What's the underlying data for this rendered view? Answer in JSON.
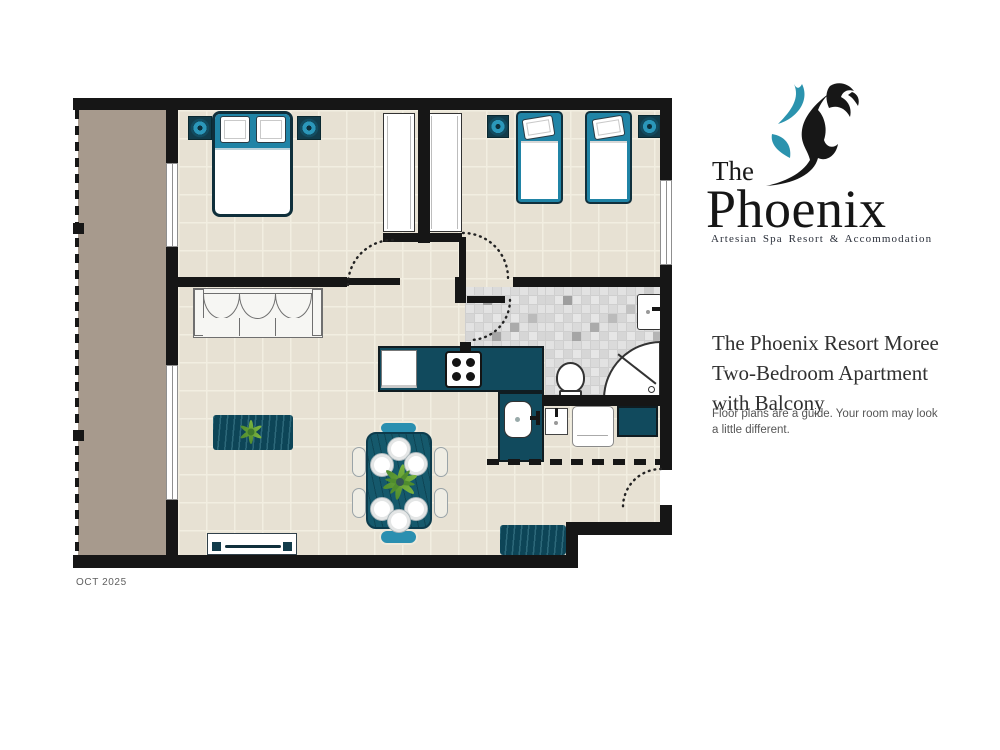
{
  "logo": {
    "prefix": "The",
    "name": "Phoenix",
    "tagline": "Artesian Spa Resort & Accommodation"
  },
  "details": {
    "title_lines": [
      "The Phoenix Resort Moree",
      "Two-Bedroom Apartment",
      "with Balcony"
    ],
    "disclaimer": "Floor plans are a guide. Your room may look a little different."
  },
  "date_label": "OCT 2025",
  "palette": {
    "brand_teal": "#2b93ae",
    "ink_black": "#171717",
    "wall": "#161616",
    "floor": "#e7e1d3",
    "floor_grid": "#f2eee1",
    "balcony": "#a79a8d",
    "counter_teal": "#114a5d",
    "headboard_teal": "#2084a6",
    "chair_teal": "#2a8fb0",
    "rug_teal": "#0d4557",
    "mosaic_gray": "#d9d9d9",
    "plant_green": "#7cb43f"
  },
  "floorplan": {
    "rooms": [
      {
        "name": "balcony",
        "furniture": []
      },
      {
        "name": "master-bedroom",
        "furniture": [
          "double-bed",
          "nightstand",
          "nightstand",
          "wardrobe"
        ]
      },
      {
        "name": "second-bedroom",
        "furniture": [
          "single-bed",
          "single-bed",
          "nightstand",
          "nightstand",
          "wardrobe"
        ]
      },
      {
        "name": "living-room",
        "furniture": [
          "sofa",
          "tv-console",
          "rug",
          "plant"
        ]
      },
      {
        "name": "dining-area",
        "furniture": [
          "dining-table",
          "chairs",
          "plates",
          "plant"
        ]
      },
      {
        "name": "kitchen",
        "furniture": [
          "fridge",
          "stove",
          "sink"
        ]
      },
      {
        "name": "bathroom",
        "furniture": [
          "toilet",
          "corner-shower",
          "vanity-basin"
        ]
      },
      {
        "name": "laundry",
        "furniture": [
          "laundry-basin",
          "washing-machine"
        ]
      },
      {
        "name": "entry",
        "furniture": [
          "entry-rug"
        ]
      }
    ]
  }
}
